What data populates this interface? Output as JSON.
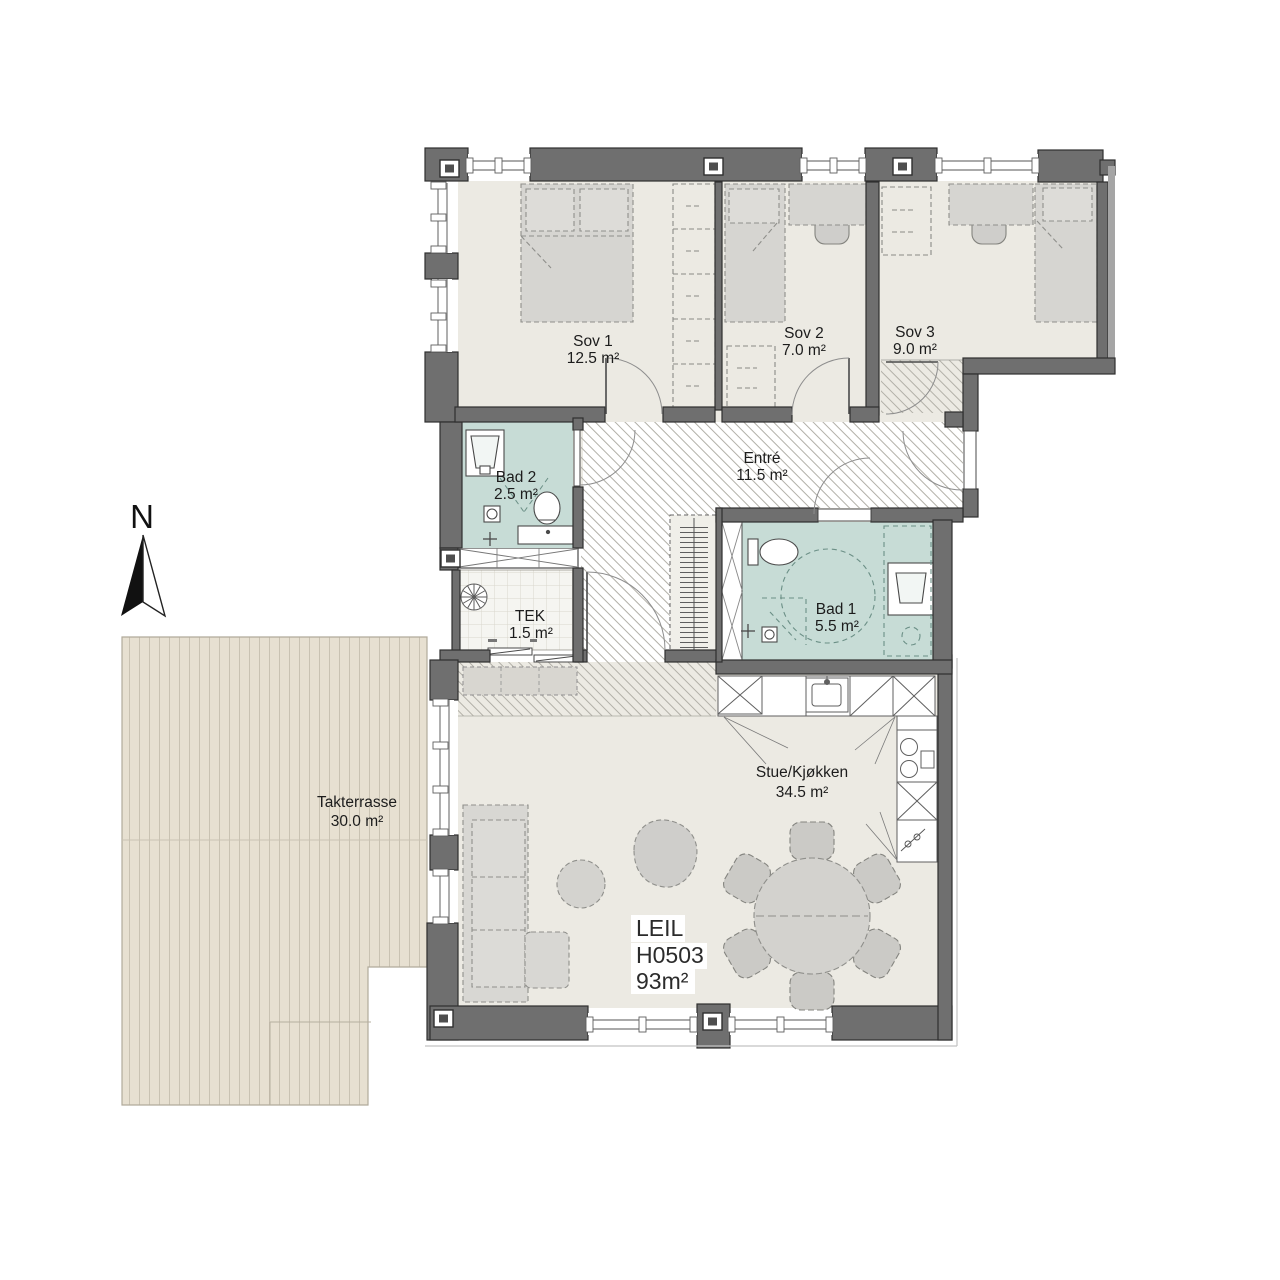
{
  "plan_type": "apartment floor plan",
  "north": {
    "label": "N"
  },
  "apartment": {
    "line1": "LEIL",
    "line2": "H0503",
    "line3": "93m²"
  },
  "rooms": {
    "sov1": {
      "name": "Sov 1",
      "area": "12.5 m²"
    },
    "sov2": {
      "name": "Sov 2",
      "area": "7.0 m²"
    },
    "sov3": {
      "name": "Sov 3",
      "area": "9.0 m²"
    },
    "bad2": {
      "name": "Bad 2",
      "area": "2.5 m²"
    },
    "entre": {
      "name": "Entré",
      "area": "11.5 m²"
    },
    "tek": {
      "name": "TEK",
      "area": "1.5 m²"
    },
    "bad1": {
      "name": "Bad 1",
      "area": "5.5 m²"
    },
    "stue": {
      "name": "Stue/Kjøkken",
      "area": "34.5 m²"
    },
    "terrace": {
      "name": "Takterrasse",
      "area": "30.0 m²"
    }
  },
  "colors": {
    "wall": "#6f6f6f",
    "wall_outline": "#2f2f2f",
    "floor": "#eceae3",
    "bathroom_floor": "#c7dcd6",
    "terrace_deck": "#e7e0d1",
    "furniture": "#d6d5d1",
    "hatch_line": "#b2b0a8",
    "accessibility_circle": "#7fa399"
  },
  "icons": {
    "north_arrow": "compass-needle",
    "vent": "wall-vent-square",
    "fan": "ventilation-fan",
    "drain": "floor-drain",
    "turning_circle": "wheelchair-turning-circle"
  }
}
